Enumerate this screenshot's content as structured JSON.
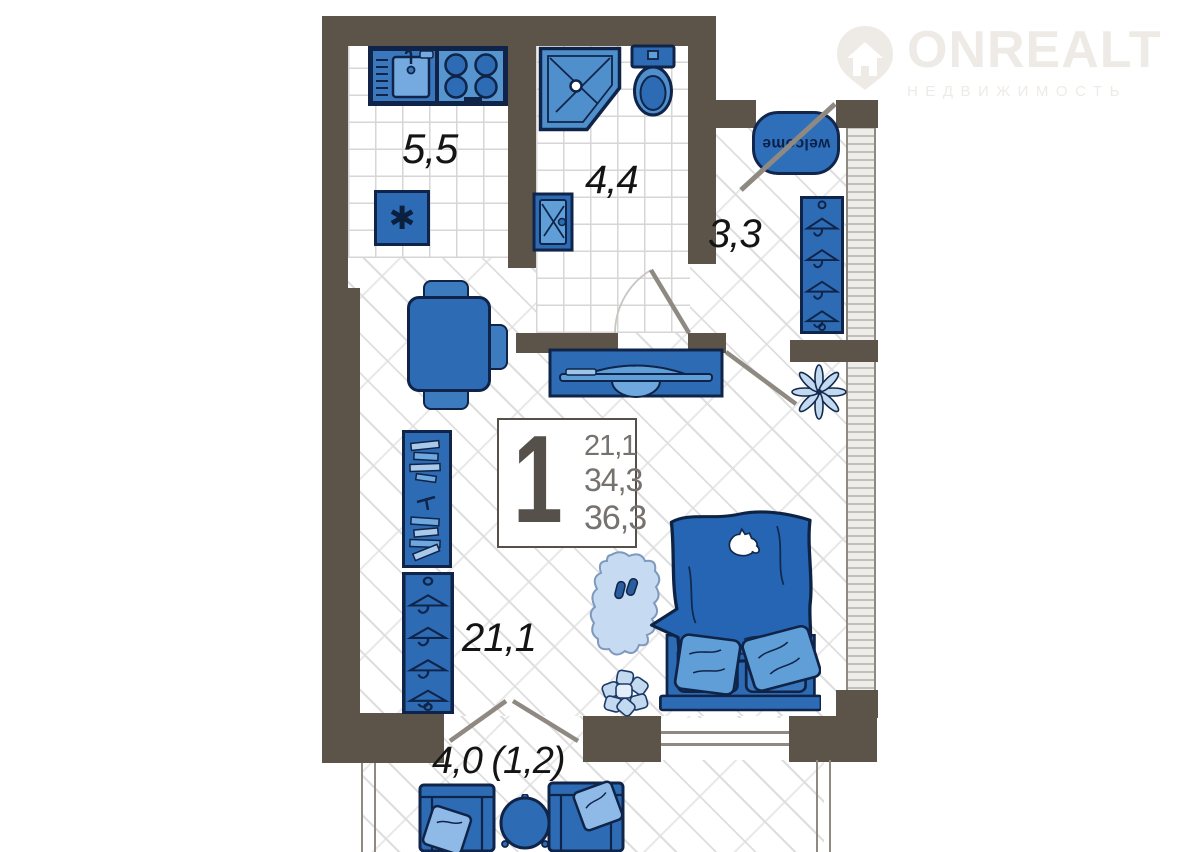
{
  "brand": {
    "name": "ONREALT",
    "subtitle": "НЕДВИЖИМОСТЬ"
  },
  "plan": {
    "unit": {
      "rooms_count": "1",
      "area_living": "21,1",
      "area_no_balcony": "34,3",
      "area_total": "36,3"
    },
    "areas": {
      "kitchen": "5,5",
      "bathroom": "4,4",
      "hallway": "3,3",
      "living": "21,1",
      "balcony": "4,0 (1,2)"
    },
    "mat_text": "welcome",
    "icons": {
      "fridge_snowflake": "✱",
      "logo_pin": "house-location-pin"
    },
    "palette": {
      "wall": "#5d5449",
      "blue_main": "#2d6cb4",
      "blue_deep": "#2565b3",
      "blue_medium": "#4f90cc",
      "blue_light": "#8fb9e6",
      "blue_pale": "#c3d9f0",
      "outline": "#0f2448",
      "floor_grid": "#d6d6d6",
      "door": "#8e8981",
      "label": "#141414",
      "logo": "#eeebe7"
    }
  }
}
